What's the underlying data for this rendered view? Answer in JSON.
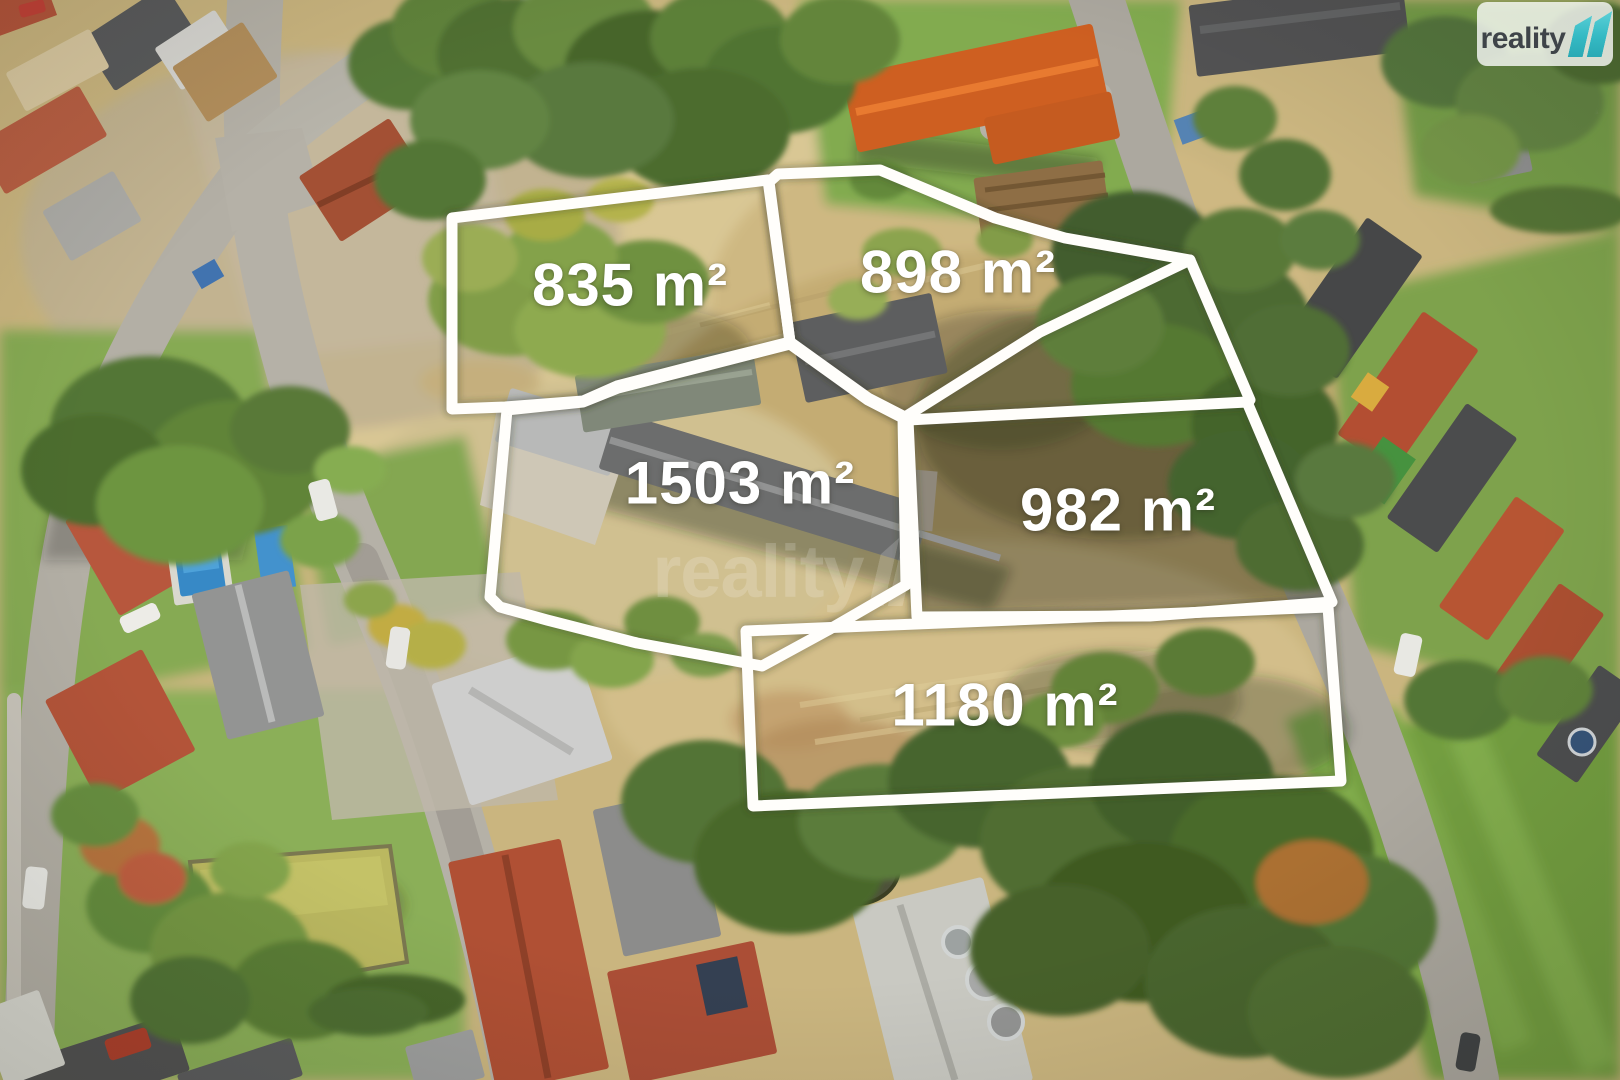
{
  "branding": {
    "logo_text": "reality",
    "logo_mark_icon": "reality-11-ribbon-icon",
    "brand_teal": "#3ac0ca",
    "logo_text_color": "#3f4449"
  },
  "watermark": {
    "text": "reality",
    "mark_icon": "reality-11-ribbon-icon"
  },
  "overlay": {
    "outline_color": "#ffffff"
  },
  "parcels": [
    {
      "id": "835",
      "label": "835 m²"
    },
    {
      "id": "898",
      "label": "898 m²"
    },
    {
      "id": "1503",
      "label": "1503 m²"
    },
    {
      "id": "982",
      "label": "982 m²"
    },
    {
      "id": "1180",
      "label": "1180 m²"
    }
  ]
}
